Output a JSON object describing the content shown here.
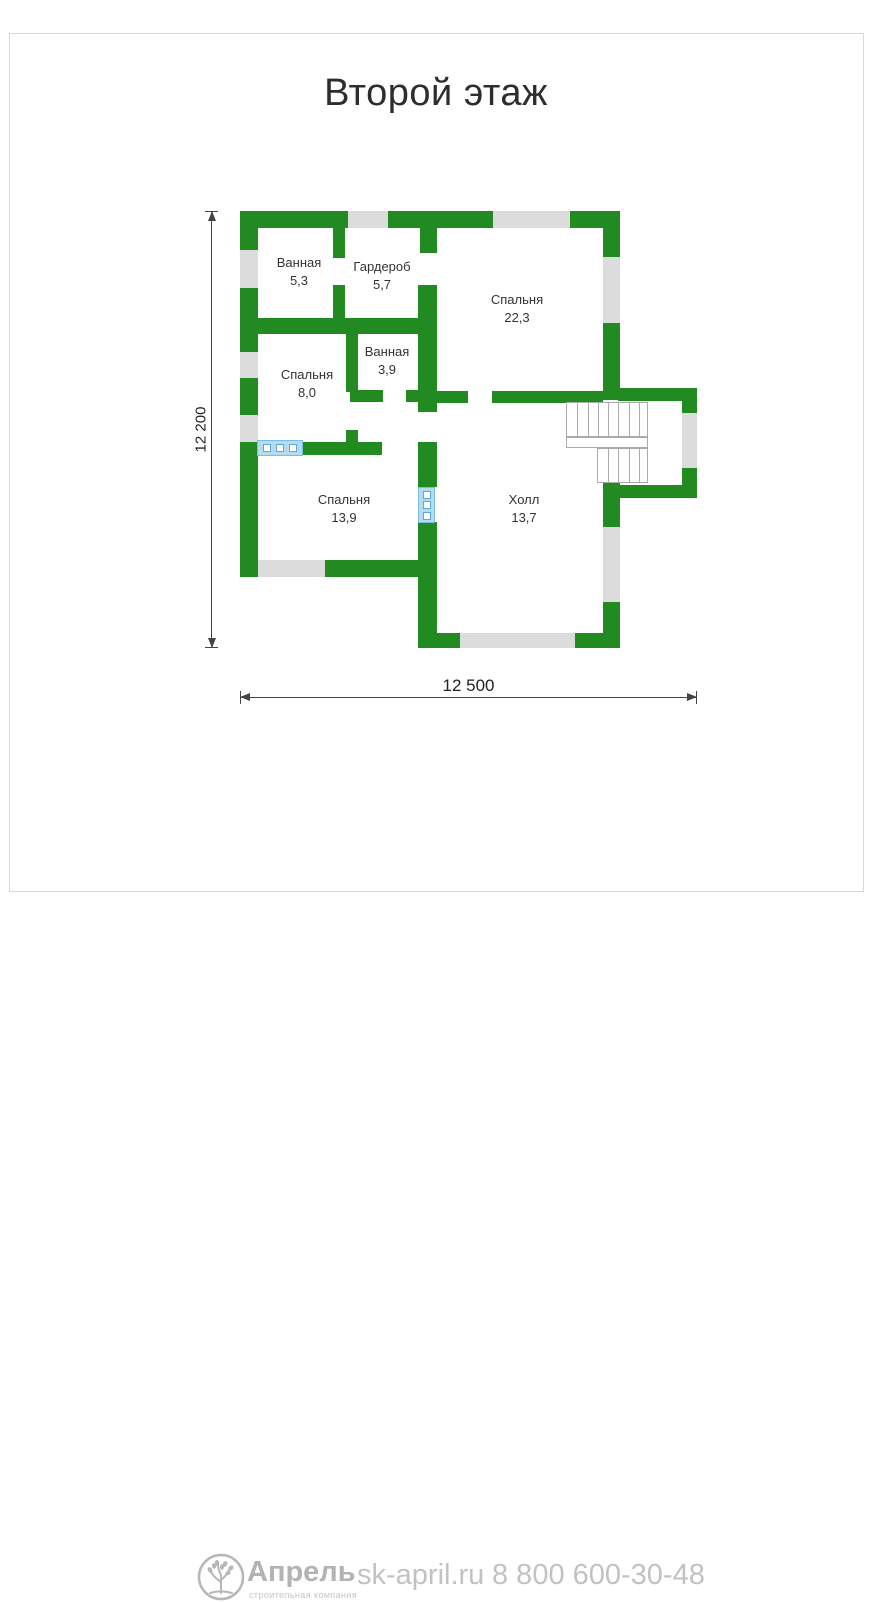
{
  "title": "Второй этаж",
  "dimensions": {
    "height_label": "12 200",
    "width_label": "12 500"
  },
  "rooms": [
    {
      "name": "Ванная",
      "area": "5,3",
      "x": 299,
      "y": 254
    },
    {
      "name": "Гардероб",
      "area": "5,7",
      "x": 382,
      "y": 258
    },
    {
      "name": "Спальня",
      "area": "22,3",
      "x": 517,
      "y": 291
    },
    {
      "name": "Ванная",
      "area": "3,9",
      "x": 387,
      "y": 343
    },
    {
      "name": "Спальня",
      "area": "8,0",
      "x": 307,
      "y": 366
    },
    {
      "name": "Спальня",
      "area": "13,9",
      "x": 344,
      "y": 491
    },
    {
      "name": "Холл",
      "area": "13,7",
      "x": 524,
      "y": 491
    }
  ],
  "plan": {
    "walls": [
      [
        240,
        211,
        108,
        17
      ],
      [
        388,
        211,
        105,
        17
      ],
      [
        570,
        211,
        50,
        17
      ],
      [
        240,
        211,
        18,
        39
      ],
      [
        240,
        288,
        18,
        64
      ],
      [
        240,
        378,
        18,
        37
      ],
      [
        240,
        442,
        18,
        135
      ],
      [
        603,
        211,
        17,
        46
      ],
      [
        603,
        323,
        17,
        77
      ],
      [
        603,
        483,
        17,
        44
      ],
      [
        603,
        602,
        17,
        46
      ],
      [
        618,
        388,
        79,
        13
      ],
      [
        682,
        388,
        15,
        25
      ],
      [
        682,
        468,
        15,
        30
      ],
      [
        618,
        485,
        79,
        13
      ],
      [
        325,
        560,
        110,
        17
      ],
      [
        418,
        633,
        42,
        15
      ],
      [
        575,
        633,
        45,
        15
      ],
      [
        420,
        228,
        17,
        25
      ],
      [
        418,
        285,
        19,
        127
      ],
      [
        418,
        442,
        19,
        45
      ],
      [
        418,
        522,
        19,
        111
      ],
      [
        258,
        318,
        162,
        16
      ],
      [
        333,
        228,
        12,
        30
      ],
      [
        333,
        285,
        12,
        33
      ],
      [
        346,
        322,
        12,
        70
      ],
      [
        346,
        430,
        12,
        12
      ],
      [
        350,
        390,
        33,
        12
      ],
      [
        406,
        390,
        12,
        12
      ],
      [
        437,
        391,
        31,
        12
      ],
      [
        492,
        391,
        111,
        12
      ],
      [
        302,
        442,
        80,
        13
      ]
    ],
    "windows": [
      [
        348,
        211,
        40,
        17
      ],
      [
        493,
        211,
        77,
        17
      ],
      [
        240,
        250,
        18,
        38
      ],
      [
        240,
        352,
        18,
        26
      ],
      [
        240,
        415,
        18,
        27
      ],
      [
        603,
        257,
        17,
        66
      ],
      [
        603,
        527,
        17,
        75
      ],
      [
        682,
        413,
        15,
        55
      ],
      [
        258,
        560,
        67,
        17
      ],
      [
        460,
        633,
        115,
        15
      ]
    ],
    "vents": [
      {
        "x": 257,
        "y": 440,
        "w": 46,
        "h": 16,
        "dir": "h"
      },
      {
        "x": 418,
        "y": 487,
        "w": 17,
        "h": 36,
        "dir": "v"
      }
    ],
    "stairs": [
      {
        "name": "stairs-upper-flight",
        "box": [
          566,
          402,
          82,
          35
        ],
        "treads": 7
      },
      {
        "name": "stairs-landing",
        "box": [
          566,
          437,
          82,
          11
        ],
        "treads": 0
      },
      {
        "name": "stairs-lower-flight",
        "box": [
          597,
          448,
          51,
          35
        ],
        "treads": 4
      }
    ]
  },
  "footer": {
    "brand": "Апрель",
    "brand_subtitle": "строительная компания",
    "website": "sk-april.ru",
    "phone": "8 800 600-30-48"
  },
  "colors": {
    "wall": "#218a21",
    "window": "#dcdcdc",
    "vent_fill": "#b3dcf0",
    "vent_border": "#5aa8d6",
    "dimension": "#444444",
    "footer_text": "#bdbdbd"
  }
}
